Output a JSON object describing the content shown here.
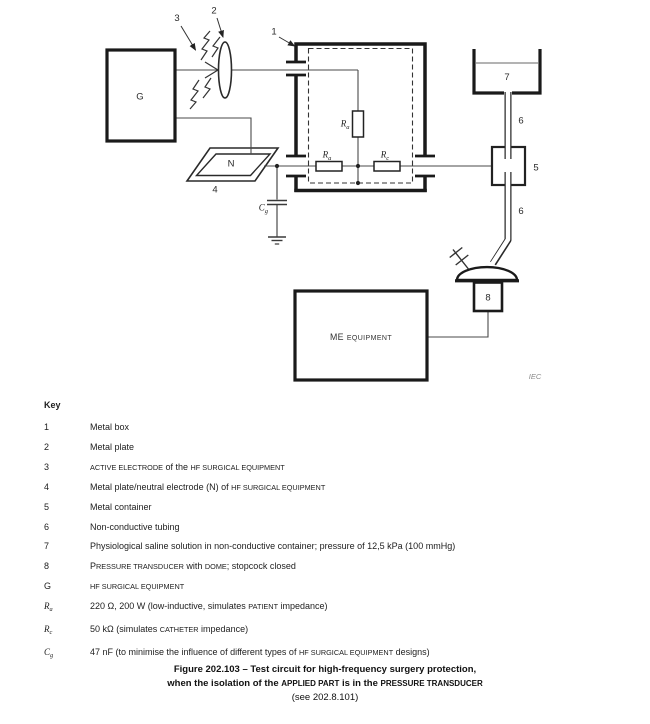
{
  "diagram": {
    "callouts": {
      "c1": "1",
      "c2": "2",
      "c3": "3",
      "c4": "4",
      "c5": "5",
      "c6_upper": "6",
      "c6_lower": "6",
      "c7": "7",
      "c8": "8"
    },
    "generator_label": "G",
    "neutral_label": "N",
    "resistor_ra_vertical": {
      "main": "R",
      "sub": "a"
    },
    "resistor_ra_horizontal": {
      "main": "R",
      "sub": "a"
    },
    "resistor_rc": {
      "main": "R",
      "sub": "c"
    },
    "capacitor_cg": {
      "main": "C",
      "sub": "g"
    },
    "me_equipment": {
      "lead": "ME",
      "rest": "EQUIPMENT"
    },
    "iec": "IEC"
  },
  "key": {
    "heading": "Key",
    "rows": [
      {
        "sym": [
          [
            "n",
            "1"
          ]
        ],
        "desc": [
          [
            "n",
            "Metal box"
          ]
        ]
      },
      {
        "sym": [
          [
            "n",
            "2"
          ]
        ],
        "desc": [
          [
            "n",
            "Metal plate"
          ]
        ]
      },
      {
        "sym": [
          [
            "n",
            "3"
          ]
        ],
        "desc": [
          [
            "sc",
            "ACTIVE ELECTRODE"
          ],
          [
            "n",
            " of the "
          ],
          [
            "sc",
            "HF SURGICAL EQUIPMENT"
          ]
        ]
      },
      {
        "sym": [
          [
            "n",
            "4"
          ]
        ],
        "desc": [
          [
            "n",
            "Metal plate/neutral electrode (N) of "
          ],
          [
            "sc",
            "HF SURGICAL EQUIPMENT"
          ]
        ]
      },
      {
        "sym": [
          [
            "n",
            "5"
          ]
        ],
        "desc": [
          [
            "n",
            "Metal container"
          ]
        ]
      },
      {
        "sym": [
          [
            "n",
            "6"
          ]
        ],
        "desc": [
          [
            "n",
            "Non-conductive tubing"
          ]
        ]
      },
      {
        "sym": [
          [
            "n",
            "7"
          ]
        ],
        "desc": [
          [
            "n",
            "Physiological saline solution in non-conductive container; pressure of 12,5 kPa (100 mmHg)"
          ]
        ]
      },
      {
        "sym": [
          [
            "n",
            "8"
          ]
        ],
        "desc": [
          [
            "n",
            "P"
          ],
          [
            "sc",
            "RESSURE TRANSDUCER"
          ],
          [
            "n",
            " with "
          ],
          [
            "sc",
            "DOME"
          ],
          [
            "n",
            "; stopcock closed"
          ]
        ]
      },
      {
        "sym": [
          [
            "n",
            "G"
          ]
        ],
        "desc": [
          [
            "sc",
            "HF SURGICAL EQUIPMENT"
          ]
        ]
      },
      {
        "sym": [
          [
            "i",
            "R"
          ],
          [
            "sub",
            "a"
          ]
        ],
        "desc": [
          [
            "n",
            "220 Ω, 200 W (low-inductive, simulates "
          ],
          [
            "sc",
            "PATIENT"
          ],
          [
            "n",
            " impedance)"
          ]
        ]
      },
      {
        "sym": [
          [
            "i",
            "R"
          ],
          [
            "sub",
            "c"
          ]
        ],
        "desc": [
          [
            "n",
            "50 kΩ (simulates "
          ],
          [
            "sc",
            "CATHETER"
          ],
          [
            "n",
            " impedance)"
          ]
        ]
      },
      {
        "sym": [
          [
            "i",
            "C"
          ],
          [
            "sub",
            "g"
          ]
        ],
        "desc": [
          [
            "n",
            "47 nF (to minimise the influence of different types of "
          ],
          [
            "sc",
            "HF SURGICAL EQUIPMENT"
          ],
          [
            "n",
            " designs)"
          ]
        ]
      }
    ]
  },
  "caption": {
    "line1": [
      [
        "n",
        "Figure 202.103 – Test circuit for high-frequency surgery protection,"
      ]
    ],
    "line2": [
      [
        "n",
        "when the isolation of the "
      ],
      [
        "sc",
        "APPLIED PART"
      ],
      [
        "n",
        " is in the "
      ],
      [
        "sc",
        "PRESSURE TRANSDUCER"
      ]
    ],
    "line3": [
      [
        "n",
        "(see 202.8.101)"
      ]
    ]
  },
  "colors": {
    "line": "#4a4a4a",
    "heavy": "#1a1a1a",
    "liquid_line": "#9a9a9a",
    "iec_gray": "#8a8a8a"
  }
}
